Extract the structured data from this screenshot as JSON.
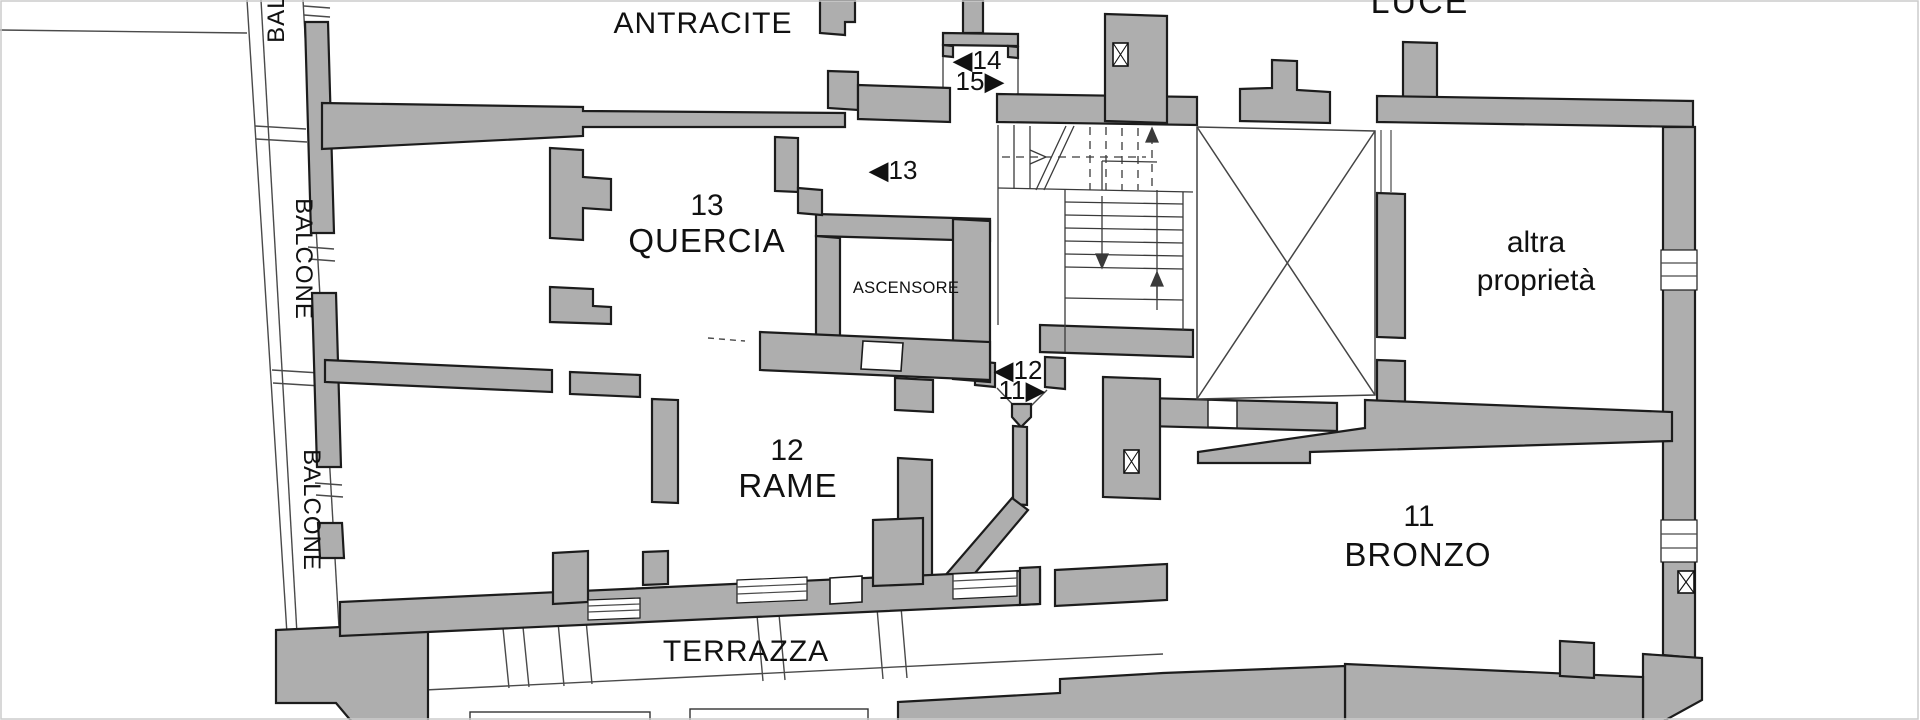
{
  "plan": {
    "type": "floor-plan",
    "colors": {
      "wall_fill": "#aeaeae",
      "outline": "#1c1c1c",
      "thin_line": "#4a4a4a",
      "background": "#ffffff",
      "text": "#111111"
    },
    "apartments": [
      {
        "number": "14",
        "name": "ANTRACITE"
      },
      {
        "number": "13",
        "name": "QUERCIA"
      },
      {
        "number": "12",
        "name": "RAME"
      },
      {
        "number": "11",
        "name": "BRONZO"
      }
    ],
    "areas": {
      "elevator": "ASCENSORE",
      "terrace": "TERRAZZA",
      "balcony": "BALCONE",
      "light_well": "LUCE",
      "other_property": [
        "altra",
        "proprietà"
      ]
    },
    "door_markers": [
      {
        "apartment": "14",
        "label": "◀14"
      },
      {
        "apartment": "15",
        "label": "15▶"
      },
      {
        "apartment": "13",
        "label": "◀13"
      },
      {
        "apartment": "12",
        "label": "◀12"
      },
      {
        "apartment": "11",
        "label": "11▶"
      }
    ]
  }
}
